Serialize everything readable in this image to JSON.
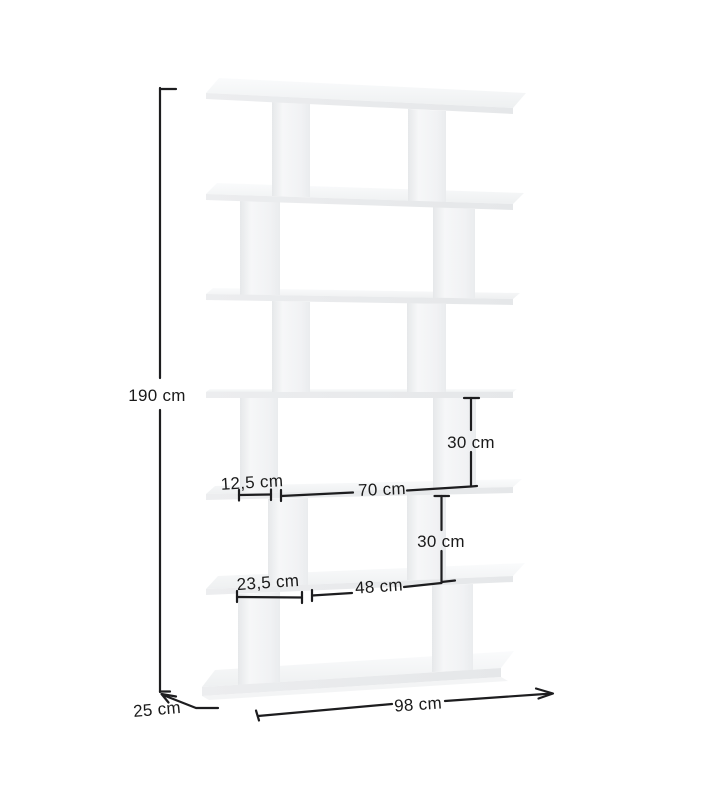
{
  "page": {
    "background_color": "#ffffff"
  },
  "diagram": {
    "type": "product-dimension-diagram",
    "subject": "six-tier zigzag bookcase, perspective line render",
    "furniture_fill_color": "#f2f3f5",
    "furniture_edge_color": "#e7e9eb",
    "dimension_line_color": "#1d1d1f",
    "label_text_color": "#1a1a1a",
    "annotations": {
      "height": "190 cm",
      "depth": "25 cm",
      "width": "98 cm",
      "upper_shelf_gap": "30 cm",
      "lower_shelf_gap": "30 cm",
      "upper_left_offset": "12,5 cm",
      "upper_opening_width": "70 cm",
      "lower_left_offset": "23,5 cm",
      "lower_opening_width": "48 cm"
    }
  }
}
